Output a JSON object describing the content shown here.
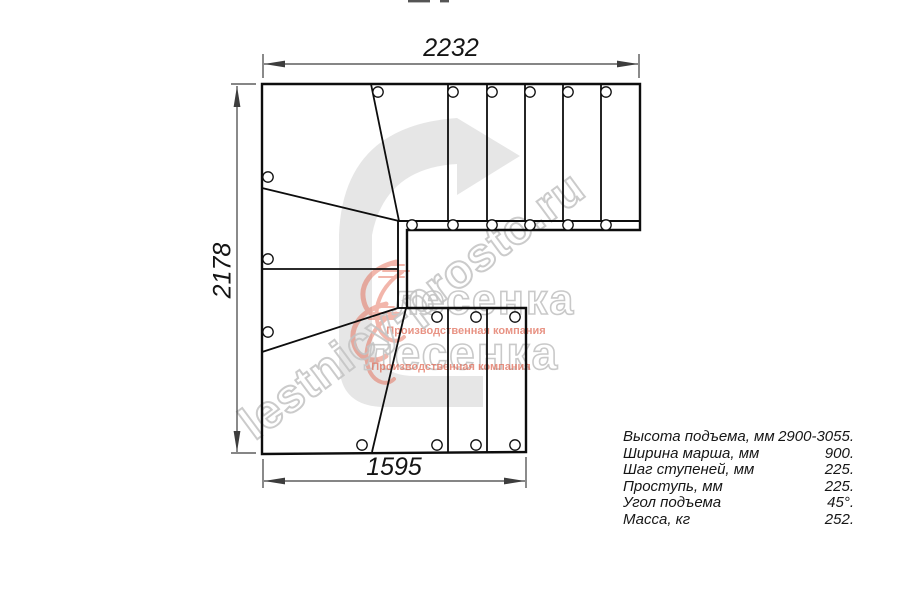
{
  "drawing": {
    "dim_top": "2232",
    "dim_left": "2178",
    "dim_bottom": "1595"
  },
  "specs": {
    "rows": [
      {
        "label": "Высота подъема, мм",
        "value": "2900-3055."
      },
      {
        "label": "Ширина марша, мм",
        "value": "900."
      },
      {
        "label": "Шаг ступеней, мм",
        "value": "225."
      },
      {
        "label": "Проступь, мм",
        "value": "225."
      },
      {
        "label": "Угол подъема",
        "value": "45°."
      },
      {
        "label": "Масса, кг",
        "value": "252."
      }
    ]
  },
  "watermarks": {
    "site": "lestnicy-prosto.ru",
    "logo_text": "лесенка",
    "logo_caption": "Производственная компания"
  },
  "colors": {
    "line": "#111111",
    "dim": "#3d3d3d",
    "watermark_gray": "#c6c6c6",
    "logo_red": "#e2543a",
    "arrow_gray": "#d6d6d6"
  }
}
